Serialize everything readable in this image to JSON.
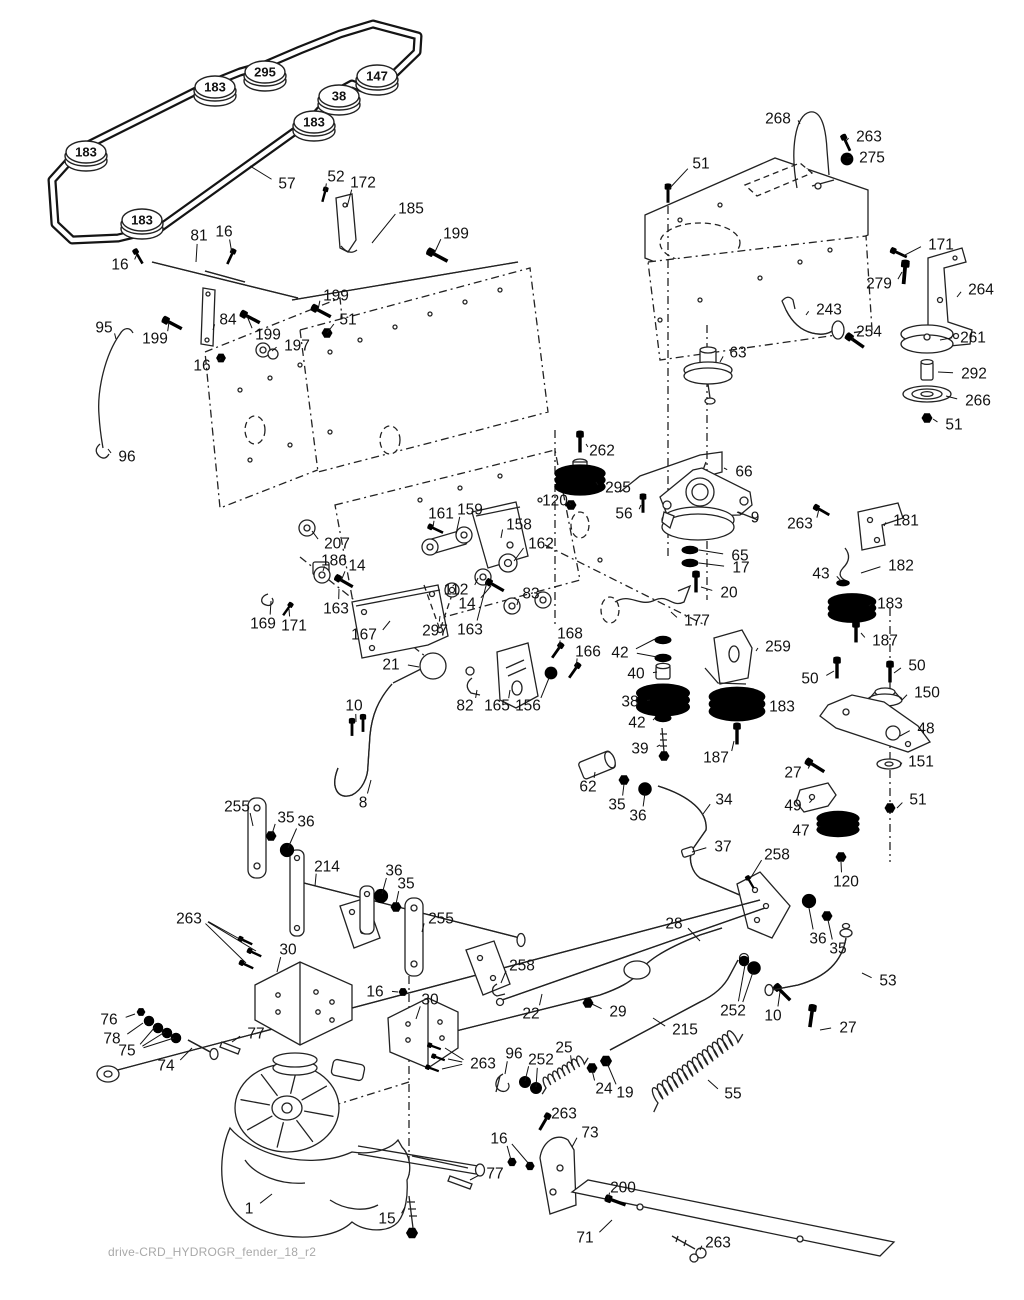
{
  "page": {
    "width": 1024,
    "height": 1300,
    "background": "#ffffff",
    "footer": "drive-CRD_HYDROGR_fender_18_r2",
    "ink": "#222222",
    "gray": "#a9a9a9"
  },
  "belt_labels": [
    {
      "n": "183",
      "x": 215,
      "y": 87
    },
    {
      "n": "295",
      "x": 265,
      "y": 72
    },
    {
      "n": "147",
      "x": 377,
      "y": 76
    },
    {
      "n": "38",
      "x": 339,
      "y": 96
    },
    {
      "n": "183",
      "x": 314,
      "y": 122
    },
    {
      "n": "183",
      "x": 86,
      "y": 152
    },
    {
      "n": "183",
      "x": 142,
      "y": 220
    }
  ],
  "labels": [
    {
      "n": "57",
      "x": 287,
      "y": 183,
      "t": [
        250,
        166
      ]
    },
    {
      "n": "52",
      "x": 336,
      "y": 176,
      "t": [
        325,
        192
      ]
    },
    {
      "n": "172",
      "x": 363,
      "y": 182,
      "t": [
        347,
        207
      ]
    },
    {
      "n": "185",
      "x": 411,
      "y": 208,
      "t": [
        372,
        243
      ]
    },
    {
      "n": "199",
      "x": 456,
      "y": 233,
      "t": [
        434,
        254
      ]
    },
    {
      "n": "81",
      "x": 199,
      "y": 235,
      "t": [
        196,
        262
      ]
    },
    {
      "n": "16",
      "x": 224,
      "y": 231,
      "t": [
        232,
        254
      ]
    },
    {
      "n": "16",
      "x": 120,
      "y": 264,
      "t": [
        137,
        254
      ]
    },
    {
      "n": "199",
      "x": 336,
      "y": 295,
      "t": [
        318,
        310
      ]
    },
    {
      "n": "84",
      "x": 228,
      "y": 319,
      "t": [
        213,
        330
      ]
    },
    {
      "n": "51",
      "x": 348,
      "y": 319,
      "t": [
        327,
        333
      ]
    },
    {
      "n": "199",
      "x": 268,
      "y": 334,
      "t": [
        247,
        316
      ]
    },
    {
      "n": "197",
      "x": 297,
      "y": 345,
      "t": [
        272,
        351
      ]
    },
    {
      "n": "16",
      "x": 202,
      "y": 365,
      "t": [
        221,
        358
      ]
    },
    {
      "n": "95",
      "x": 104,
      "y": 327,
      "t": [
        116,
        339
      ]
    },
    {
      "n": "199",
      "x": 155,
      "y": 338,
      "t": [
        169,
        322
      ]
    },
    {
      "n": "96",
      "x": 127,
      "y": 456,
      "t": [
        108,
        449
      ]
    },
    {
      "n": "268",
      "x": 778,
      "y": 118,
      "t": [
        800,
        124
      ]
    },
    {
      "n": "263",
      "x": 869,
      "y": 136,
      "t": [
        845,
        142
      ]
    },
    {
      "n": "275",
      "x": 872,
      "y": 157,
      "t": [
        847,
        158
      ]
    },
    {
      "n": "51",
      "x": 701,
      "y": 163,
      "t": [
        668,
        190
      ]
    },
    {
      "n": "171",
      "x": 941,
      "y": 244,
      "t": [
        903,
        256
      ]
    },
    {
      "n": "279",
      "x": 879,
      "y": 283,
      "t": [
        902,
        272
      ]
    },
    {
      "n": "264",
      "x": 981,
      "y": 289,
      "t": [
        957,
        297
      ]
    },
    {
      "n": "243",
      "x": 829,
      "y": 309,
      "t": [
        806,
        315
      ]
    },
    {
      "n": "254",
      "x": 869,
      "y": 331,
      "t": [
        852,
        341
      ]
    },
    {
      "n": "261",
      "x": 973,
      "y": 337,
      "t": [
        940,
        340
      ]
    },
    {
      "n": "292",
      "x": 974,
      "y": 373,
      "t": [
        938,
        372
      ]
    },
    {
      "n": "266",
      "x": 978,
      "y": 400,
      "t": [
        946,
        396
      ]
    },
    {
      "n": "51",
      "x": 954,
      "y": 424,
      "t": [
        933,
        419
      ]
    },
    {
      "n": "63",
      "x": 738,
      "y": 352,
      "t": [
        720,
        362
      ]
    },
    {
      "n": "66",
      "x": 744,
      "y": 471,
      "t": [
        724,
        468
      ]
    },
    {
      "n": "262",
      "x": 602,
      "y": 450,
      "t": [
        586,
        444
      ]
    },
    {
      "n": "295",
      "x": 618,
      "y": 487,
      "t": [
        596,
        482
      ]
    },
    {
      "n": "120",
      "x": 555,
      "y": 500,
      "t": [
        571,
        505
      ]
    },
    {
      "n": "56",
      "x": 624,
      "y": 513,
      "t": [
        641,
        505
      ]
    },
    {
      "n": "9",
      "x": 755,
      "y": 517,
      "t": [
        737,
        512
      ]
    },
    {
      "n": "263",
      "x": 800,
      "y": 523,
      "t": [
        819,
        509
      ]
    },
    {
      "n": "181",
      "x": 906,
      "y": 520,
      "t": [
        884,
        526
      ]
    },
    {
      "n": "65",
      "x": 740,
      "y": 555,
      "t": [
        699,
        550
      ]
    },
    {
      "n": "17",
      "x": 741,
      "y": 567,
      "t": [
        699,
        563
      ]
    },
    {
      "n": "182",
      "x": 901,
      "y": 565,
      "t": [
        861,
        573
      ]
    },
    {
      "n": "43",
      "x": 821,
      "y": 573,
      "t": [
        841,
        581
      ]
    },
    {
      "n": "20",
      "x": 729,
      "y": 592,
      "t": [
        701,
        587
      ]
    },
    {
      "n": "183",
      "x": 890,
      "y": 603,
      "t": [
        869,
        606
      ]
    },
    {
      "n": "187",
      "x": 885,
      "y": 640,
      "t": [
        861,
        633
      ]
    },
    {
      "n": "207",
      "x": 337,
      "y": 543,
      "t": [
        312,
        531
      ]
    },
    {
      "n": "161",
      "x": 441,
      "y": 513,
      "t": [
        433,
        527
      ]
    },
    {
      "n": "159",
      "x": 470,
      "y": 509,
      "t": [
        456,
        534
      ]
    },
    {
      "n": "158",
      "x": 519,
      "y": 524,
      "t": [
        501,
        538
      ]
    },
    {
      "n": "162",
      "x": 541,
      "y": 543,
      "t": [
        514,
        561
      ]
    },
    {
      "n": "186",
      "x": 334,
      "y": 560,
      "t": [
        323,
        571
      ]
    },
    {
      "n": "14",
      "x": 357,
      "y": 565,
      "t": [
        341,
        581
      ]
    },
    {
      "n": "112",
      "x": 456,
      "y": 589,
      "t": [
        478,
        578
      ]
    },
    {
      "n": "14",
      "x": 467,
      "y": 603,
      "t": [
        491,
        586
      ]
    },
    {
      "n": "83",
      "x": 531,
      "y": 593,
      "t": [
        517,
        605
      ]
    },
    {
      "n": "163",
      "x": 336,
      "y": 608,
      "t": [
        339,
        589
      ]
    },
    {
      "n": "163",
      "x": 470,
      "y": 629,
      "t": [
        487,
        582
      ]
    },
    {
      "n": "169",
      "x": 263,
      "y": 623,
      "t": [
        271,
        601
      ]
    },
    {
      "n": "171",
      "x": 294,
      "y": 625,
      "t": [
        289,
        609
      ]
    },
    {
      "n": "167",
      "x": 364,
      "y": 634,
      "t": [
        390,
        621
      ]
    },
    {
      "n": "297",
      "x": 435,
      "y": 630,
      "t": [
        440,
        616
      ]
    },
    {
      "n": "177",
      "x": 697,
      "y": 620,
      "t": [
        671,
        612
      ]
    },
    {
      "n": "259",
      "x": 778,
      "y": 646,
      "t": [
        756,
        651
      ]
    },
    {
      "n": "168",
      "x": 570,
      "y": 633,
      "t": [
        559,
        649
      ]
    },
    {
      "n": "166",
      "x": 588,
      "y": 651,
      "t": [
        576,
        669
      ]
    },
    {
      "n": "42",
      "x": 620,
      "y": 652,
      "t": [
        [
          655,
          639
        ],
        [
          657,
          657
        ]
      ]
    },
    {
      "n": "40",
      "x": 636,
      "y": 673,
      "t": [
        657,
        672
      ]
    },
    {
      "n": "38",
      "x": 630,
      "y": 701,
      "t": [
        650,
        700
      ]
    },
    {
      "n": "42",
      "x": 637,
      "y": 722,
      "t": [
        655,
        718
      ]
    },
    {
      "n": "39",
      "x": 640,
      "y": 748,
      "t": [
        660,
        745
      ]
    },
    {
      "n": "187",
      "x": 716,
      "y": 757,
      "t": [
        734,
        741
      ]
    },
    {
      "n": "183",
      "x": 782,
      "y": 706,
      "t": [
        763,
        705
      ]
    },
    {
      "n": "50",
      "x": 810,
      "y": 678,
      "t": [
        834,
        671
      ]
    },
    {
      "n": "50",
      "x": 917,
      "y": 665,
      "t": [
        894,
        673
      ]
    },
    {
      "n": "150",
      "x": 927,
      "y": 692,
      "t": [
        902,
        700
      ]
    },
    {
      "n": "48",
      "x": 926,
      "y": 728,
      "t": [
        900,
        736
      ]
    },
    {
      "n": "151",
      "x": 921,
      "y": 761,
      "t": [
        900,
        765
      ]
    },
    {
      "n": "27",
      "x": 793,
      "y": 772,
      "t": [
        810,
        765
      ]
    },
    {
      "n": "51",
      "x": 918,
      "y": 799,
      "t": [
        897,
        808
      ]
    },
    {
      "n": "49",
      "x": 793,
      "y": 805,
      "t": [
        812,
        800
      ]
    },
    {
      "n": "47",
      "x": 801,
      "y": 830,
      "t": [
        820,
        826
      ]
    },
    {
      "n": "21",
      "x": 391,
      "y": 664,
      "t": [
        419,
        667
      ]
    },
    {
      "n": "10",
      "x": 354,
      "y": 705,
      "t": [
        356,
        722
      ]
    },
    {
      "n": "82",
      "x": 465,
      "y": 705,
      "t": [
        477,
        690
      ]
    },
    {
      "n": "165",
      "x": 497,
      "y": 705,
      "t": [
        510,
        690
      ]
    },
    {
      "n": "156",
      "x": 528,
      "y": 705,
      "t": [
        549,
        678
      ]
    },
    {
      "n": "62",
      "x": 588,
      "y": 786,
      "t": [
        595,
        772
      ]
    },
    {
      "n": "35",
      "x": 617,
      "y": 804,
      "t": [
        624,
        784
      ]
    },
    {
      "n": "36",
      "x": 638,
      "y": 815,
      "t": [
        645,
        793
      ]
    },
    {
      "n": "34",
      "x": 724,
      "y": 799,
      "t": [
        703,
        814
      ]
    },
    {
      "n": "37",
      "x": 723,
      "y": 846,
      "t": [
        692,
        852
      ]
    },
    {
      "n": "8",
      "x": 363,
      "y": 802,
      "t": [
        371,
        780
      ]
    },
    {
      "n": "255",
      "x": 237,
      "y": 806,
      "t": [
        253,
        826
      ]
    },
    {
      "n": "35",
      "x": 286,
      "y": 817,
      "t": [
        272,
        834
      ]
    },
    {
      "n": "36",
      "x": 306,
      "y": 821,
      "t": [
        288,
        848
      ]
    },
    {
      "n": "214",
      "x": 327,
      "y": 866,
      "t": [
        315,
        886
      ]
    },
    {
      "n": "36",
      "x": 394,
      "y": 870,
      "t": [
        382,
        894
      ]
    },
    {
      "n": "35",
      "x": 406,
      "y": 883,
      "t": [
        396,
        904
      ]
    },
    {
      "n": "255",
      "x": 441,
      "y": 918,
      "t": [
        422,
        932
      ]
    },
    {
      "n": "263",
      "x": 189,
      "y": 918,
      "t": [
        [
          245,
          942
        ],
        [
          256,
          951
        ],
        [
          246,
          963
        ]
      ]
    },
    {
      "n": "30",
      "x": 288,
      "y": 949,
      "t": [
        277,
        972
      ]
    },
    {
      "n": "258",
      "x": 777,
      "y": 854,
      "t": [
        750,
        879
      ]
    },
    {
      "n": "120",
      "x": 846,
      "y": 881,
      "t": [
        841,
        862
      ]
    },
    {
      "n": "28",
      "x": 674,
      "y": 923,
      "t": [
        700,
        941
      ]
    },
    {
      "n": "36",
      "x": 818,
      "y": 938,
      "t": [
        809,
        908
      ]
    },
    {
      "n": "35",
      "x": 838,
      "y": 948,
      "t": [
        828,
        920
      ]
    },
    {
      "n": "53",
      "x": 888,
      "y": 980,
      "t": [
        862,
        973
      ]
    },
    {
      "n": "258",
      "x": 522,
      "y": 965,
      "t": [
        501,
        983
      ]
    },
    {
      "n": "22",
      "x": 531,
      "y": 1013,
      "t": [
        542,
        994
      ]
    },
    {
      "n": "29",
      "x": 618,
      "y": 1011,
      "t": [
        592,
        1004
      ]
    },
    {
      "n": "215",
      "x": 685,
      "y": 1029,
      "t": [
        653,
        1018
      ]
    },
    {
      "n": "252",
      "x": 733,
      "y": 1010,
      "t": [
        [
          753,
          972
        ],
        [
          745,
          965
        ]
      ]
    },
    {
      "n": "10",
      "x": 773,
      "y": 1015,
      "t": [
        780,
        992
      ]
    },
    {
      "n": "27",
      "x": 848,
      "y": 1027,
      "t": [
        820,
        1030
      ]
    },
    {
      "n": "16",
      "x": 375,
      "y": 991,
      "t": [
        398,
        992
      ]
    },
    {
      "n": "30",
      "x": 430,
      "y": 999,
      "t": [
        416,
        1019
      ]
    },
    {
      "n": "263",
      "x": 483,
      "y": 1063,
      "t": [
        [
          445,
          1048
        ],
        [
          448,
          1059
        ],
        [
          442,
          1069
        ]
      ]
    },
    {
      "n": "76",
      "x": 109,
      "y": 1019,
      "t": [
        135,
        1014
      ]
    },
    {
      "n": "78",
      "x": 112,
      "y": 1038,
      "t": [
        143,
        1023
      ]
    },
    {
      "n": "75",
      "x": 127,
      "y": 1050,
      "t": [
        [
          155,
          1027
        ],
        [
          165,
          1032
        ],
        [
          174,
          1038
        ]
      ]
    },
    {
      "n": "74",
      "x": 166,
      "y": 1065,
      "t": [
        192,
        1048
      ]
    },
    {
      "n": "77",
      "x": 256,
      "y": 1033,
      "t": [
        232,
        1042
      ]
    },
    {
      "n": "96",
      "x": 514,
      "y": 1053,
      "t": [
        505,
        1074
      ]
    },
    {
      "n": "252",
      "x": 541,
      "y": 1059,
      "t": [
        [
          525,
          1081
        ],
        [
          536,
          1087
        ]
      ]
    },
    {
      "n": "25",
      "x": 564,
      "y": 1047,
      "t": [
        572,
        1066
      ]
    },
    {
      "n": "24",
      "x": 604,
      "y": 1088,
      "t": [
        592,
        1070
      ]
    },
    {
      "n": "19",
      "x": 625,
      "y": 1092,
      "t": [
        607,
        1063
      ]
    },
    {
      "n": "55",
      "x": 733,
      "y": 1093,
      "t": [
        708,
        1080
      ]
    },
    {
      "n": "263",
      "x": 564,
      "y": 1113,
      "t": [
        546,
        1121
      ]
    },
    {
      "n": "16",
      "x": 499,
      "y": 1138,
      "t": [
        [
          511,
          1160
        ],
        [
          529,
          1164
        ]
      ]
    },
    {
      "n": "73",
      "x": 590,
      "y": 1132,
      "t": [
        572,
        1147
      ]
    },
    {
      "n": "77",
      "x": 495,
      "y": 1173,
      "t": [
        470,
        1180
      ]
    },
    {
      "n": "200",
      "x": 623,
      "y": 1187,
      "t": [
        608,
        1199
      ]
    },
    {
      "n": "71",
      "x": 585,
      "y": 1237,
      "t": [
        612,
        1220
      ]
    },
    {
      "n": "15",
      "x": 387,
      "y": 1218,
      "t": [
        405,
        1207
      ]
    },
    {
      "n": "1",
      "x": 249,
      "y": 1208,
      "t": [
        272,
        1194
      ]
    },
    {
      "n": "263",
      "x": 718,
      "y": 1242,
      "t": [
        700,
        1250
      ]
    }
  ]
}
